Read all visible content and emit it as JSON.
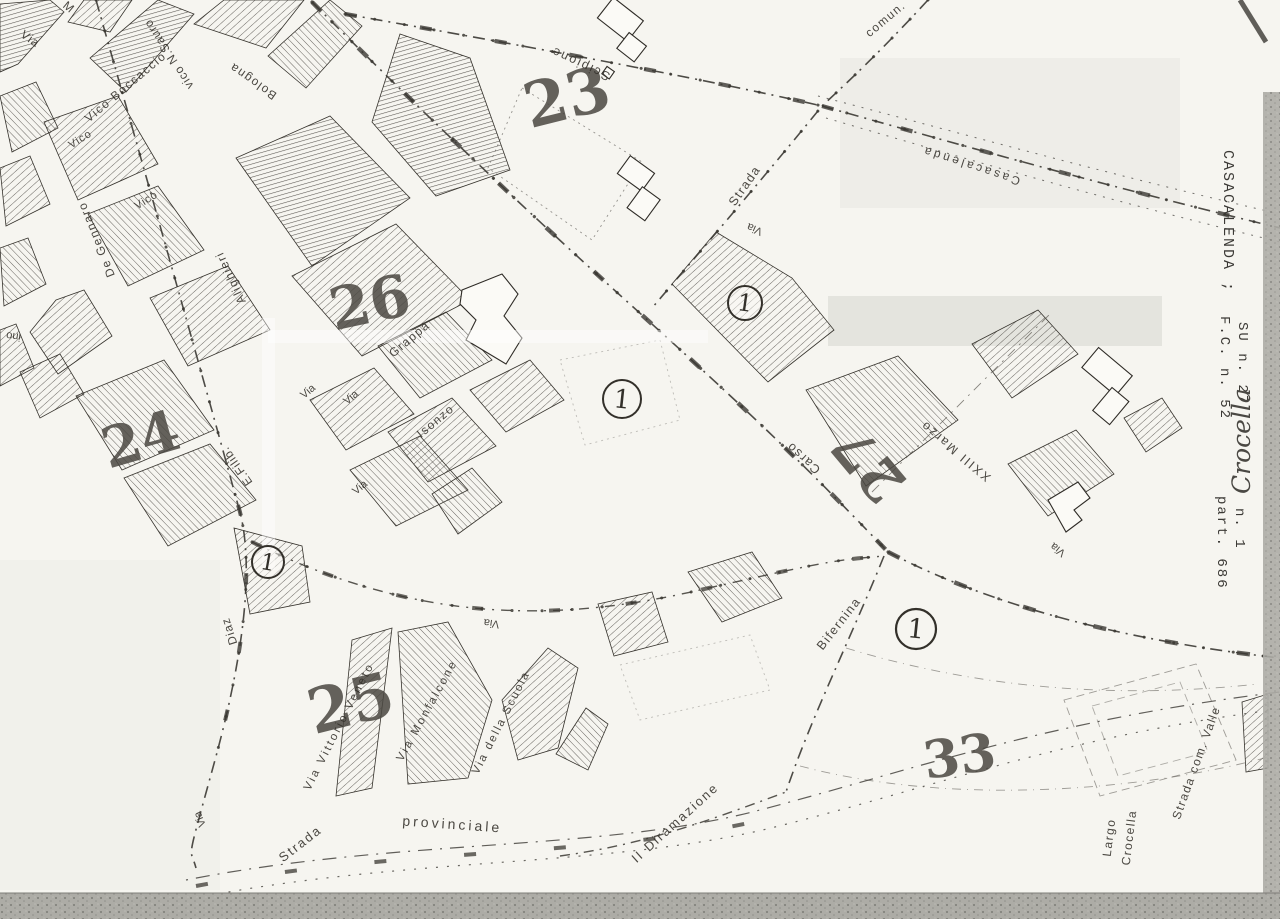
{
  "map": {
    "colors": {
      "paper": "#f6f5f0",
      "ink": "#33302a",
      "hatch": "#44413c",
      "scan_band": "#a9a8a2"
    },
    "margin_notes": [
      {
        "text": "CASACALENDA ;"
      },
      {
        "text": "F.C. n. 52"
      },
      {
        "text": "SU n. 27"
      },
      {
        "text": "Crocella"
      },
      {
        "text": "part. 686"
      },
      {
        "text": "n. 1"
      }
    ],
    "district_numbers": [
      {
        "label": "23"
      },
      {
        "label": "26"
      },
      {
        "label": "24"
      },
      {
        "label": "25"
      },
      {
        "label": "27"
      },
      {
        "label": "33"
      }
    ],
    "parcel_markers": [
      {
        "label": "1"
      },
      {
        "label": "1"
      },
      {
        "label": "1"
      },
      {
        "label": "1"
      }
    ],
    "street_labels": [
      {
        "text": "Via"
      },
      {
        "text": "M"
      },
      {
        "text": "Vico Boccaccio"
      },
      {
        "text": "vico N.Sauro"
      },
      {
        "text": "Bologna"
      },
      {
        "text": "Vico"
      },
      {
        "text": "Vico"
      },
      {
        "text": "De Gennaro"
      },
      {
        "text": "Alighieri"
      },
      {
        "text": "Via"
      },
      {
        "text": "Grappa"
      },
      {
        "text": "Via"
      },
      {
        "text": "Isonzo"
      },
      {
        "text": "Via"
      },
      {
        "text": "E.Filib."
      },
      {
        "text": "Scipione"
      },
      {
        "text": "Via"
      },
      {
        "text": "Strada"
      },
      {
        "text": "comun."
      },
      {
        "text": "Casacalenda"
      },
      {
        "text": "Carso"
      },
      {
        "text": "XXIII Marzo"
      },
      {
        "text": "Bifernina"
      },
      {
        "text": "Via"
      },
      {
        "text": "Via"
      },
      {
        "text": "Via Vittorio Veneto"
      },
      {
        "text": "Via Monfalcone"
      },
      {
        "text": "Via della Scuola"
      },
      {
        "text": "Strada"
      },
      {
        "text": "provinciale"
      },
      {
        "text": "II Diramazione"
      },
      {
        "text": "Largo"
      },
      {
        "text": "Crocella"
      },
      {
        "text": "Strada com. Valle"
      },
      {
        "text": "Via"
      },
      {
        "text": "Diaz"
      },
      {
        "text": "ino"
      }
    ]
  }
}
